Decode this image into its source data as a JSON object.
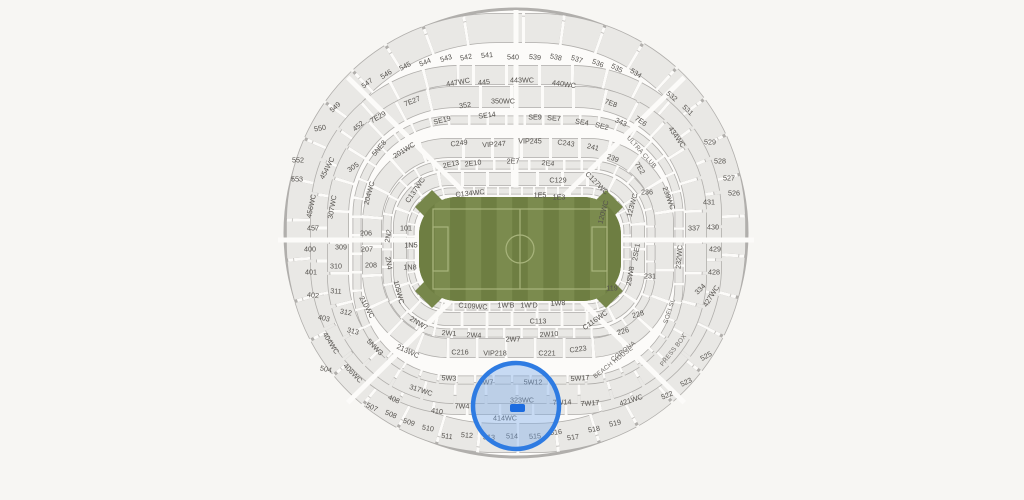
{
  "canvas": {
    "w": 1024,
    "h": 500,
    "bg": "#f7f6f3"
  },
  "stadium": {
    "rim": {
      "cx": 516,
      "cy": 233,
      "rx": 231,
      "ry": 224,
      "stroke": "#b1afac",
      "inner_stroke": "#c9c7c4",
      "fill": "#fcfbf9"
    },
    "colors": {
      "band_outline": "#b0aeab",
      "band_fill": "#e9e8e5",
      "aisle": "#fcfbf9",
      "label": "#55524e"
    },
    "bands": [
      {
        "cx": 516,
        "cy": 233,
        "w": 430,
        "h": 410,
        "r": 195,
        "th": 30,
        "dash": 36,
        "gap": 3,
        "off": 10
      },
      {
        "cx": 516,
        "cy": 240,
        "w": 392,
        "h": 330,
        "r": 140,
        "th": 20,
        "dash": 30,
        "gap": 3,
        "off": 18
      },
      {
        "cx": 517,
        "cy": 245,
        "w": 358,
        "h": 296,
        "r": 118,
        "th": 22,
        "dash": 28,
        "gap": 3,
        "off": 5
      },
      {
        "cx": 518,
        "cy": 250,
        "w": 322,
        "h": 260,
        "r": 95,
        "th": 9,
        "dash": 16,
        "gap": 2.5,
        "off": 0
      },
      {
        "cx": 518,
        "cy": 248,
        "w": 292,
        "h": 200,
        "r": 76,
        "th": 20,
        "dash": 26,
        "gap": 3,
        "off": 12
      },
      {
        "cx": 519,
        "cy": 249,
        "w": 264,
        "h": 168,
        "r": 60,
        "th": 9,
        "dash": 15,
        "gap": 2.5,
        "off": 4
      },
      {
        "cx": 519,
        "cy": 249,
        "w": 238,
        "h": 140,
        "r": 48,
        "th": 14,
        "dash": 22,
        "gap": 3,
        "off": 9
      },
      {
        "cx": 519,
        "cy": 249,
        "w": 216,
        "h": 116,
        "r": 40,
        "th": 7,
        "dash": 10,
        "gap": 2,
        "off": 0
      }
    ],
    "spokes": {
      "angles": [
        0,
        45,
        135,
        180,
        225,
        270,
        315
      ],
      "width": 5,
      "r_in": 58,
      "rx": 238,
      "ry": 230
    },
    "field": {
      "x": 419,
      "y": 197,
      "w": 202,
      "h": 104,
      "r": 38,
      "base": "#77874b",
      "stripe_dark": "#6e7e42",
      "stripe_light": "#7b8b4e",
      "line": "#a8b47c",
      "stripes": 13,
      "pitch": {
        "inset_x": 14,
        "inset_y": 12,
        "circle_r": 14,
        "box_w": 15,
        "box_h": 44
      }
    },
    "highlight": {
      "cx": 516,
      "cy": 406,
      "r": 43,
      "stroke": "#2e7be2",
      "stroke_w": 4.5,
      "fill": "rgba(120,170,235,0.40)",
      "marker": {
        "x": 510,
        "y": 404,
        "w": 15,
        "h": 8,
        "r": 2,
        "color": "#1b6be0"
      }
    },
    "labels": {
      "sections": [
        {
          "t": "540",
          "x": 513,
          "y": 57,
          "r": 0
        },
        {
          "t": "539",
          "x": 535,
          "y": 57,
          "r": 6
        },
        {
          "t": "538",
          "x": 556,
          "y": 57,
          "r": 12
        },
        {
          "t": "537",
          "x": 577,
          "y": 59,
          "r": 17
        },
        {
          "t": "536",
          "x": 598,
          "y": 63,
          "r": 22
        },
        {
          "t": "535",
          "x": 617,
          "y": 68,
          "r": 27
        },
        {
          "t": "534",
          "x": 636,
          "y": 73,
          "r": 32
        },
        {
          "t": "532",
          "x": 672,
          "y": 96,
          "r": 40
        },
        {
          "t": "531",
          "x": 688,
          "y": 110,
          "r": 44
        },
        {
          "t": "529",
          "x": 710,
          "y": 142,
          "r": 0
        },
        {
          "t": "528",
          "x": 720,
          "y": 161,
          "r": 0
        },
        {
          "t": "527",
          "x": 729,
          "y": 178,
          "r": 0
        },
        {
          "t": "526",
          "x": 734,
          "y": 193,
          "r": 0
        },
        {
          "t": "541",
          "x": 487,
          "y": 55,
          "r": -5
        },
        {
          "t": "542",
          "x": 466,
          "y": 57,
          "r": -11
        },
        {
          "t": "543",
          "x": 446,
          "y": 58,
          "r": -17
        },
        {
          "t": "544",
          "x": 425,
          "y": 62,
          "r": -22
        },
        {
          "t": "545",
          "x": 405,
          "y": 66,
          "r": -27
        },
        {
          "t": "546",
          "x": 386,
          "y": 74,
          "r": -32
        },
        {
          "t": "547",
          "x": 367,
          "y": 83,
          "r": -37
        },
        {
          "t": "549",
          "x": 335,
          "y": 107,
          "r": -43
        },
        {
          "t": "550",
          "x": 320,
          "y": 128,
          "r": -10
        },
        {
          "t": "552",
          "x": 298,
          "y": 160,
          "r": 0
        },
        {
          "t": "553",
          "x": 297,
          "y": 179,
          "r": 0
        },
        {
          "t": "525",
          "x": 706,
          "y": 356,
          "r": -30
        },
        {
          "t": "523",
          "x": 686,
          "y": 382,
          "r": -26
        },
        {
          "t": "522",
          "x": 667,
          "y": 395,
          "r": -22
        },
        {
          "t": "519",
          "x": 615,
          "y": 423,
          "r": -12
        },
        {
          "t": "518",
          "x": 594,
          "y": 429,
          "r": -10
        },
        {
          "t": "517",
          "x": 573,
          "y": 437,
          "r": -8
        },
        {
          "t": "516",
          "x": 556,
          "y": 432,
          "r": -6
        },
        {
          "t": "515",
          "x": 535,
          "y": 436,
          "r": -3
        },
        {
          "t": "514",
          "x": 512,
          "y": 436,
          "r": 0
        },
        {
          "t": "513",
          "x": 489,
          "y": 437,
          "r": 3
        },
        {
          "t": "512",
          "x": 467,
          "y": 435,
          "r": 5
        },
        {
          "t": "511",
          "x": 447,
          "y": 436,
          "r": 8
        },
        {
          "t": "510",
          "x": 428,
          "y": 428,
          "r": 10
        },
        {
          "t": "509",
          "x": 409,
          "y": 422,
          "r": 18
        },
        {
          "t": "508",
          "x": 391,
          "y": 414,
          "r": 22
        },
        {
          "t": "507",
          "x": 372,
          "y": 407,
          "r": 26
        },
        {
          "t": "504",
          "x": 326,
          "y": 369,
          "r": 12
        },
        {
          "t": "452",
          "x": 358,
          "y": 126,
          "r": -40
        },
        {
          "t": "454WC",
          "x": 327,
          "y": 168,
          "r": -62
        },
        {
          "t": "456WC",
          "x": 311,
          "y": 206,
          "r": -78
        },
        {
          "t": "457",
          "x": 313,
          "y": 228,
          "r": 0
        },
        {
          "t": "400",
          "x": 310,
          "y": 249,
          "r": 0
        },
        {
          "t": "401",
          "x": 311,
          "y": 272,
          "r": 0
        },
        {
          "t": "402",
          "x": 313,
          "y": 295,
          "r": 6
        },
        {
          "t": "403",
          "x": 324,
          "y": 318,
          "r": 12
        },
        {
          "t": "404WC",
          "x": 331,
          "y": 343,
          "r": 58
        },
        {
          "t": "406WC",
          "x": 353,
          "y": 373,
          "r": 46
        },
        {
          "t": "408",
          "x": 394,
          "y": 399,
          "r": 24
        },
        {
          "t": "410",
          "x": 437,
          "y": 411,
          "r": 8
        },
        {
          "t": "414WC",
          "x": 505,
          "y": 418,
          "r": 0
        },
        {
          "t": "421WC",
          "x": 631,
          "y": 400,
          "r": -18
        },
        {
          "t": "427WC",
          "x": 711,
          "y": 296,
          "r": -58
        },
        {
          "t": "434WC",
          "x": 677,
          "y": 137,
          "r": 55
        },
        {
          "t": "431",
          "x": 709,
          "y": 202,
          "r": 0
        },
        {
          "t": "430",
          "x": 713,
          "y": 227,
          "r": 0
        },
        {
          "t": "429",
          "x": 715,
          "y": 249,
          "r": 0
        },
        {
          "t": "428",
          "x": 714,
          "y": 272,
          "r": 0
        },
        {
          "t": "447WC",
          "x": 458,
          "y": 82,
          "r": -10
        },
        {
          "t": "445",
          "x": 484,
          "y": 82,
          "r": -6
        },
        {
          "t": "443WC",
          "x": 522,
          "y": 80,
          "r": 0
        },
        {
          "t": "440WC",
          "x": 564,
          "y": 84,
          "r": 8
        },
        {
          "t": "305",
          "x": 353,
          "y": 167,
          "r": -35
        },
        {
          "t": "307WC",
          "x": 332,
          "y": 207,
          "r": -80
        },
        {
          "t": "309",
          "x": 341,
          "y": 247,
          "r": 0
        },
        {
          "t": "310",
          "x": 336,
          "y": 266,
          "r": 0
        },
        {
          "t": "311",
          "x": 336,
          "y": 291,
          "r": 4
        },
        {
          "t": "312",
          "x": 346,
          "y": 312,
          "r": 10
        },
        {
          "t": "313",
          "x": 353,
          "y": 331,
          "r": 14
        },
        {
          "t": "5NW3",
          "x": 375,
          "y": 347,
          "r": 46
        },
        {
          "t": "317WC",
          "x": 421,
          "y": 390,
          "r": 18
        },
        {
          "t": "323WC",
          "x": 522,
          "y": 400,
          "r": 0
        },
        {
          "t": "350WC",
          "x": 503,
          "y": 101,
          "r": 0
        },
        {
          "t": "352",
          "x": 465,
          "y": 105,
          "r": -8
        },
        {
          "t": "343",
          "x": 621,
          "y": 122,
          "r": 25
        },
        {
          "t": "337",
          "x": 694,
          "y": 228,
          "r": 0
        },
        {
          "t": "334",
          "x": 700,
          "y": 289,
          "r": -45
        },
        {
          "t": "7E27",
          "x": 412,
          "y": 101,
          "r": -22
        },
        {
          "t": "7E29",
          "x": 378,
          "y": 117,
          "r": -30
        },
        {
          "t": "7E8",
          "x": 611,
          "y": 103,
          "r": 20
        },
        {
          "t": "7E6",
          "x": 641,
          "y": 121,
          "r": 35
        },
        {
          "t": "7E2",
          "x": 640,
          "y": 168,
          "r": 58
        },
        {
          "t": "5NE8",
          "x": 379,
          "y": 148,
          "r": -50
        },
        {
          "t": "201WC",
          "x": 404,
          "y": 150,
          "r": -32
        },
        {
          "t": "204WC",
          "x": 369,
          "y": 193,
          "r": -75
        },
        {
          "t": "206",
          "x": 366,
          "y": 233,
          "r": 0
        },
        {
          "t": "207",
          "x": 367,
          "y": 249,
          "r": 0
        },
        {
          "t": "208",
          "x": 371,
          "y": 265,
          "r": 0
        },
        {
          "t": "2N2",
          "x": 388,
          "y": 236,
          "r": -80
        },
        {
          "t": "2N4",
          "x": 389,
          "y": 263,
          "r": 80
        },
        {
          "t": "210WC",
          "x": 367,
          "y": 307,
          "r": 62
        },
        {
          "t": "213WC",
          "x": 408,
          "y": 351,
          "r": 25
        },
        {
          "t": "C249",
          "x": 459,
          "y": 143,
          "r": -8
        },
        {
          "t": "VIP247",
          "x": 494,
          "y": 144,
          "r": -4
        },
        {
          "t": "VIP245",
          "x": 530,
          "y": 141,
          "r": 0
        },
        {
          "t": "C243",
          "x": 566,
          "y": 143,
          "r": 8
        },
        {
          "t": "241",
          "x": 593,
          "y": 147,
          "r": 14
        },
        {
          "t": "239",
          "x": 613,
          "y": 158,
          "r": 20
        },
        {
          "t": "236",
          "x": 647,
          "y": 192,
          "r": 0
        },
        {
          "t": "239WC",
          "x": 669,
          "y": 198,
          "r": 70
        },
        {
          "t": "232WC",
          "x": 679,
          "y": 257,
          "r": -85
        },
        {
          "t": "231",
          "x": 650,
          "y": 276,
          "r": 0
        },
        {
          "t": "SE19",
          "x": 442,
          "y": 120,
          "r": -14
        },
        {
          "t": "SE14",
          "x": 487,
          "y": 115,
          "r": -7
        },
        {
          "t": "SE9",
          "x": 535,
          "y": 117,
          "r": 0
        },
        {
          "t": "SE7",
          "x": 554,
          "y": 118,
          "r": 4
        },
        {
          "t": "SE4",
          "x": 582,
          "y": 122,
          "r": 9
        },
        {
          "t": "SE2",
          "x": 602,
          "y": 126,
          "r": 14
        },
        {
          "t": "C216",
          "x": 460,
          "y": 352,
          "r": 0
        },
        {
          "t": "VIP218",
          "x": 495,
          "y": 353,
          "r": 0
        },
        {
          "t": "C221",
          "x": 547,
          "y": 353,
          "r": 0
        },
        {
          "t": "C223",
          "x": 578,
          "y": 349,
          "r": -8
        },
        {
          "t": "2E13",
          "x": 451,
          "y": 164,
          "r": -12
        },
        {
          "t": "2E10",
          "x": 473,
          "y": 163,
          "r": -8
        },
        {
          "t": "2E7",
          "x": 513,
          "y": 161,
          "r": 0
        },
        {
          "t": "2E4",
          "x": 548,
          "y": 163,
          "r": 6
        },
        {
          "t": "2W1",
          "x": 449,
          "y": 333,
          "r": 4
        },
        {
          "t": "2W4",
          "x": 474,
          "y": 335,
          "r": 2
        },
        {
          "t": "2W7",
          "x": 513,
          "y": 339,
          "r": 0
        },
        {
          "t": "2W10",
          "x": 549,
          "y": 334,
          "r": -4
        },
        {
          "t": "2NW7",
          "x": 419,
          "y": 323,
          "r": 32
        },
        {
          "t": "5W3",
          "x": 449,
          "y": 378,
          "r": 2
        },
        {
          "t": "5W7",
          "x": 486,
          "y": 382,
          "r": 0
        },
        {
          "t": "5W12",
          "x": 533,
          "y": 382,
          "r": 0
        },
        {
          "t": "5W17",
          "x": 580,
          "y": 378,
          "r": -4
        },
        {
          "t": "7W4",
          "x": 462,
          "y": 406,
          "r": 0
        },
        {
          "t": "7W14",
          "x": 562,
          "y": 402,
          "r": -2
        },
        {
          "t": "7W17",
          "x": 590,
          "y": 403,
          "r": -4
        },
        {
          "t": "C116WC",
          "x": 595,
          "y": 320,
          "r": -35
        },
        {
          "t": "226",
          "x": 623,
          "y": 331,
          "r": -15
        },
        {
          "t": "228",
          "x": 638,
          "y": 314,
          "r": -16
        },
        {
          "t": "2SW8",
          "x": 630,
          "y": 276,
          "r": -80
        },
        {
          "t": "2SE1",
          "x": 636,
          "y": 252,
          "r": -80
        },
        {
          "t": "119",
          "x": 612,
          "y": 288,
          "r": 0
        },
        {
          "t": "120WC",
          "x": 603,
          "y": 212,
          "r": -75
        },
        {
          "t": "123WC",
          "x": 632,
          "y": 205,
          "r": -75
        },
        {
          "t": "C127WC",
          "x": 597,
          "y": 183,
          "r": 45
        },
        {
          "t": "C129",
          "x": 558,
          "y": 180,
          "r": 0
        },
        {
          "t": "C134WC",
          "x": 470,
          "y": 193,
          "r": -6
        },
        {
          "t": "C137WC",
          "x": 415,
          "y": 190,
          "r": -55
        },
        {
          "t": "1E5",
          "x": 540,
          "y": 195,
          "r": 0
        },
        {
          "t": "1E3",
          "x": 559,
          "y": 197,
          "r": 0
        },
        {
          "t": "C109WC",
          "x": 473,
          "y": 306,
          "r": 4
        },
        {
          "t": "1W'B",
          "x": 506,
          "y": 305,
          "r": 0
        },
        {
          "t": "1W'D",
          "x": 529,
          "y": 305,
          "r": 0
        },
        {
          "t": "1W8",
          "x": 558,
          "y": 303,
          "r": -4
        },
        {
          "t": "C113",
          "x": 538,
          "y": 321,
          "r": 0
        },
        {
          "t": "101",
          "x": 406,
          "y": 228,
          "r": 0
        },
        {
          "t": "1N5",
          "x": 411,
          "y": 245,
          "r": 0
        },
        {
          "t": "1N8",
          "x": 410,
          "y": 267,
          "r": 0
        },
        {
          "t": "105WC",
          "x": 399,
          "y": 292,
          "r": 75
        }
      ],
      "amenities": [
        {
          "t": "CORONA",
          "x": 623,
          "y": 351,
          "r": -38
        },
        {
          "t": "BEACH HOUSE",
          "x": 613,
          "y": 362,
          "r": -38
        },
        {
          "t": "PRESS BOX",
          "x": 673,
          "y": 350,
          "r": -52
        },
        {
          "t": "ULTRA CLUB",
          "x": 642,
          "y": 152,
          "r": 48
        },
        {
          "t": "SOFI SL",
          "x": 669,
          "y": 311,
          "r": -72
        }
      ]
    }
  }
}
